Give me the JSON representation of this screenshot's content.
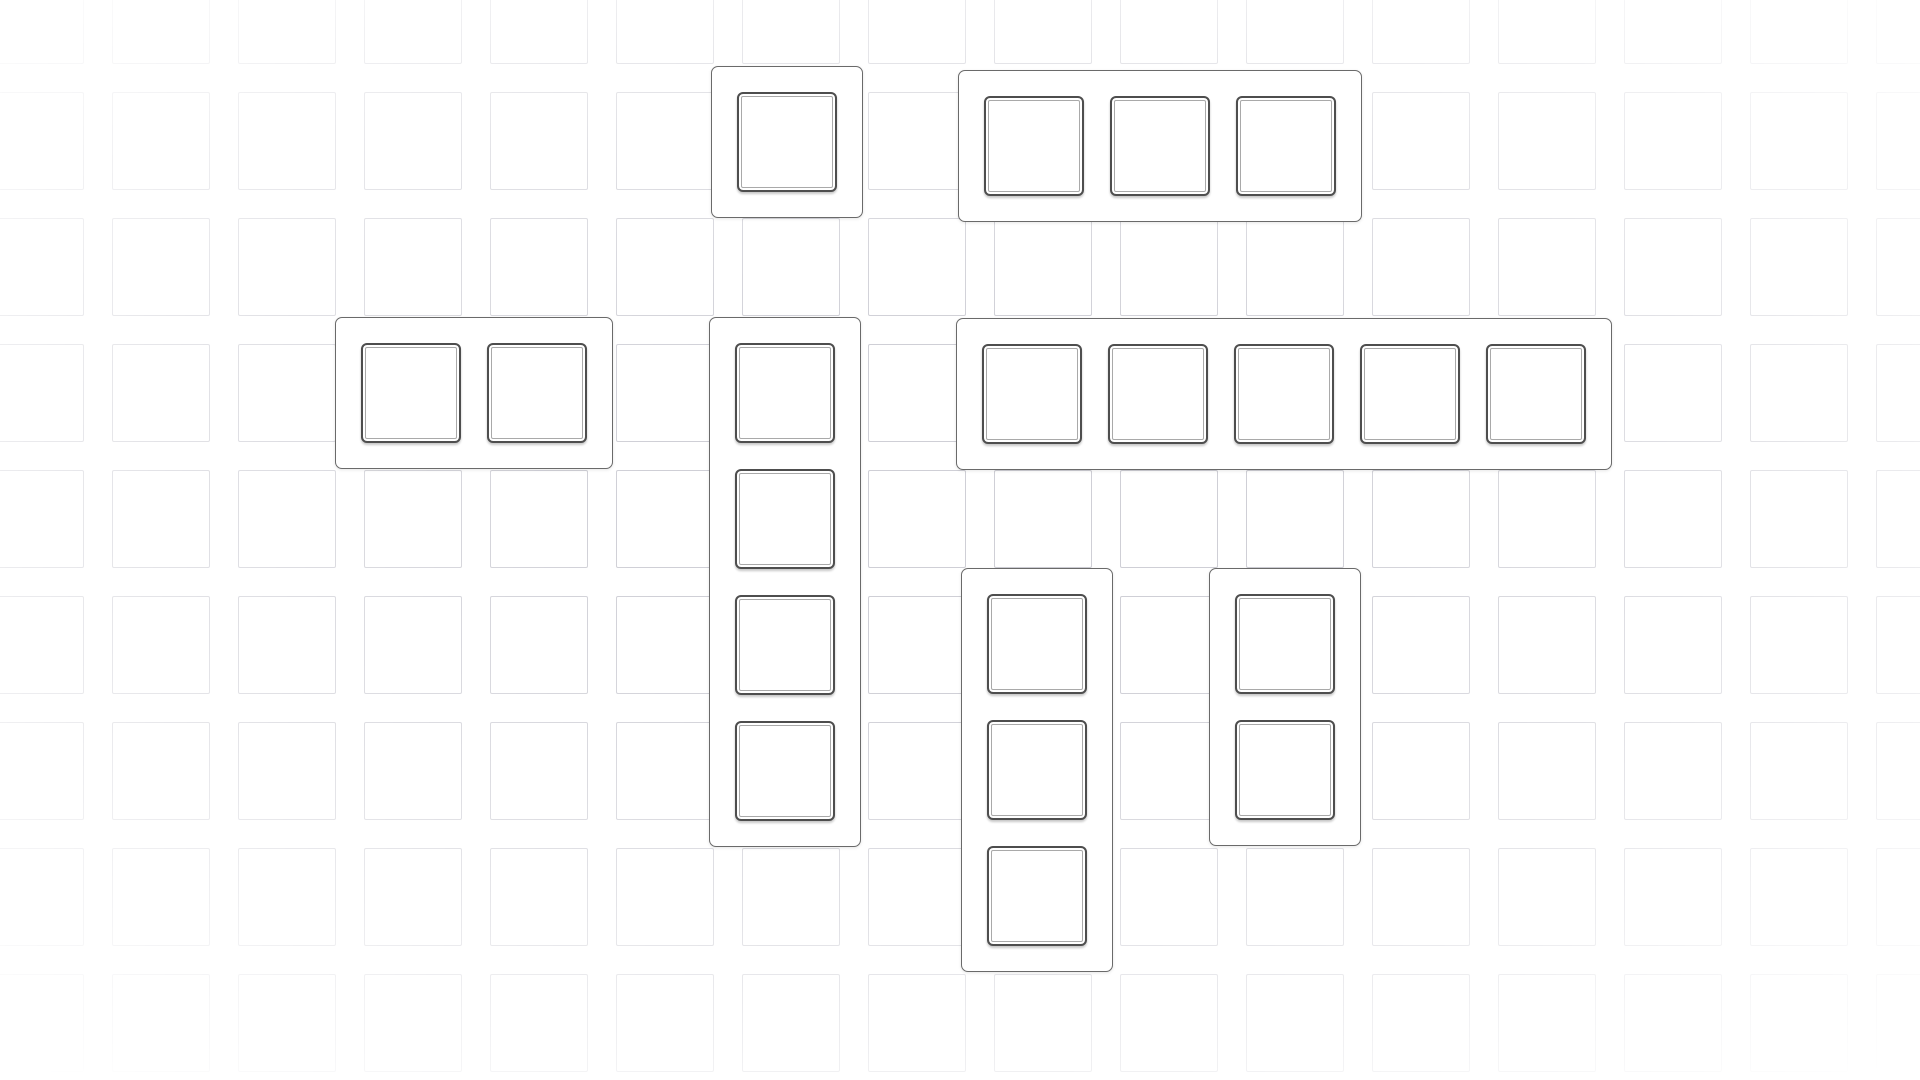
{
  "board": {
    "width": 1920,
    "height": 1080,
    "background_color": "#ffffff",
    "grid": {
      "cell_size": 98,
      "gap": 28,
      "pitch": 126,
      "offset_x": -14,
      "offset_y": -34,
      "columns": 16,
      "rows": 9,
      "line_color": "#cfcfd6",
      "edge_fade": true
    },
    "slot_style": {
      "size": 100,
      "border_color": "#4e4e4e",
      "inner_ring_color": "#a9a9a9",
      "fill": "#ffffff",
      "radius": 6
    },
    "container_style": {
      "padding": 25,
      "slot_gap": 26,
      "border_color": "#6a6a6a",
      "fill": "#ffffff",
      "radius": 7
    },
    "pieces": [
      {
        "id": "piece-1x1-top",
        "orientation": "horizontal",
        "slots": 1,
        "x": 711,
        "y": 66
      },
      {
        "id": "piece-1x3-top",
        "orientation": "horizontal",
        "slots": 3,
        "x": 958,
        "y": 70
      },
      {
        "id": "piece-1x2-left",
        "orientation": "horizontal",
        "slots": 2,
        "x": 335,
        "y": 317
      },
      {
        "id": "piece-4x1-vertical",
        "orientation": "vertical",
        "slots": 4,
        "x": 709,
        "y": 317
      },
      {
        "id": "piece-1x5-wide",
        "orientation": "horizontal",
        "slots": 5,
        "x": 956,
        "y": 318
      },
      {
        "id": "piece-3x1-vertical",
        "orientation": "vertical",
        "slots": 3,
        "x": 961,
        "y": 568
      },
      {
        "id": "piece-2x1-vertical",
        "orientation": "vertical",
        "slots": 2,
        "x": 1209,
        "y": 568
      }
    ]
  }
}
